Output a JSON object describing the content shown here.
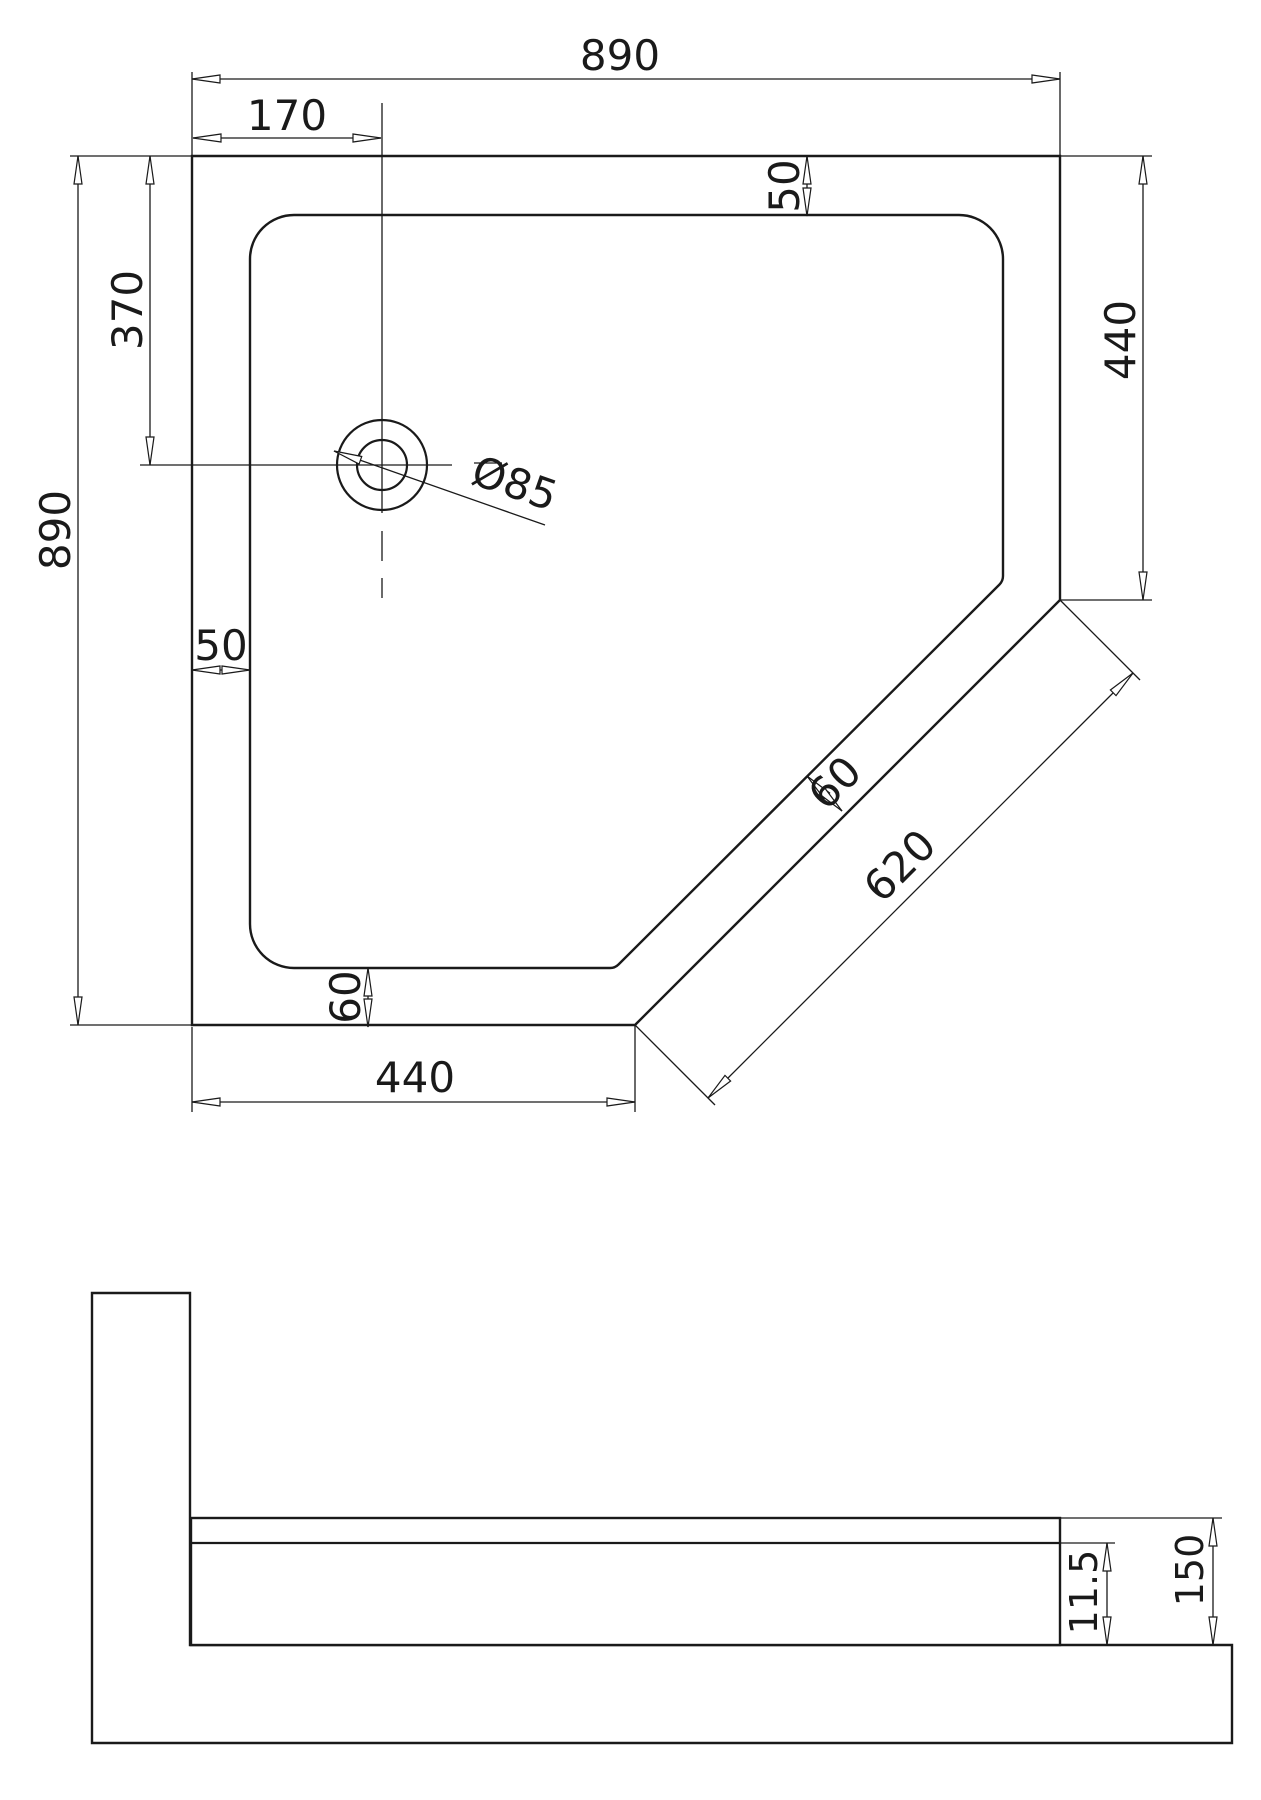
{
  "drawing": {
    "colors": {
      "line": "#1a1a1a",
      "background": "#ffffff"
    },
    "plan": {
      "dim_overall_width_top": "890",
      "dim_drain_from_left": "170",
      "dim_drain_from_top": "370",
      "dim_overall_height_left": "890",
      "dim_rim_top_right": "50",
      "dim_right_side_length": "440",
      "dim_rim_left": "50",
      "dim_drain_diameter": "Ø85",
      "dim_rim_diagonal": "60",
      "dim_diagonal_length": "620",
      "dim_rim_bottom": "60",
      "dim_bottom_side_length": "440"
    },
    "section": {
      "dim_shelf_depth": "11.5",
      "dim_total_height": "150"
    }
  }
}
